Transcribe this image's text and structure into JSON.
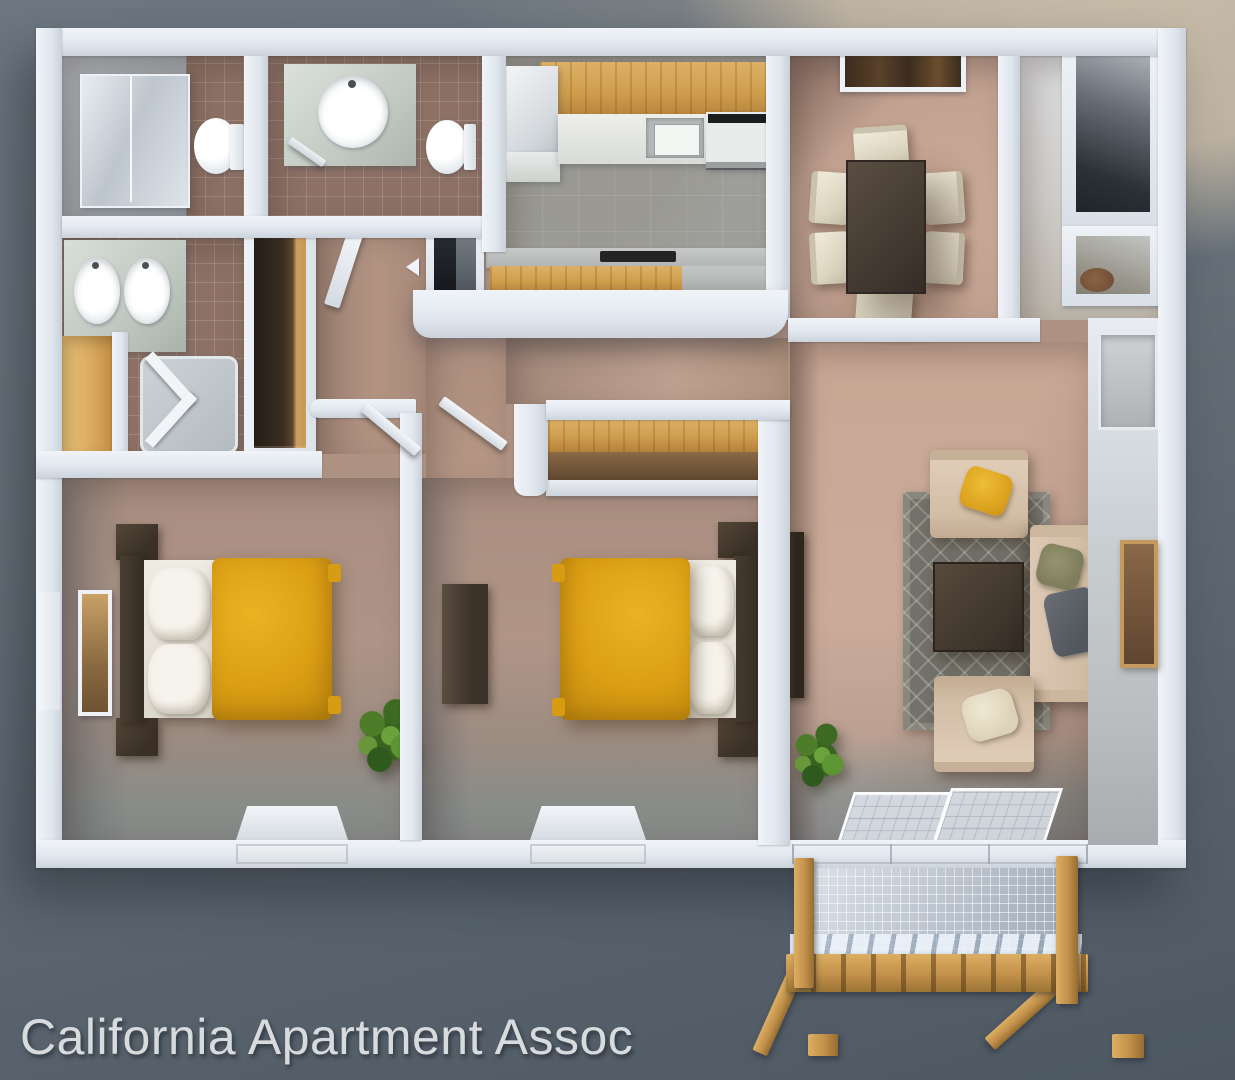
{
  "watermark": {
    "text": "California Apartment Assoc",
    "color": "#d8dbde"
  },
  "scene": {
    "type": "3d-rendered top-down apartment floor plan",
    "background_colors": {
      "slate_top": "#6d7781",
      "slate_bottom": "#4d5863",
      "beige_top_right": "#c9bca8"
    },
    "palette": {
      "wall_white": "#e8edf3",
      "bedroom_floor": "#ab9184",
      "living_floor": "#c9a897",
      "kitchen_floor": "#9e9e9a",
      "bath_tile": "#8d7165",
      "cabinet_wood": "#cf9f4e",
      "bedding_gold": "#db9e14",
      "dining_table": "#463c33",
      "chair_cream": "#e7e0ce",
      "sofa_beige": "#d6c2ac",
      "rug_gray": "#73726a",
      "balcony_wood": "#c49851"
    },
    "rooms": [
      {
        "name": "bathroom-shower",
        "furniture": [
          "glass-shower",
          "toilet",
          "tile-floor"
        ]
      },
      {
        "name": "bathroom-guest",
        "furniture": [
          "vanity-sink",
          "toilet",
          "tile-floor"
        ]
      },
      {
        "name": "master-bathroom",
        "furniture": [
          "double-sink-vanity",
          "corner-shower",
          "linen-closet"
        ]
      },
      {
        "name": "hallway",
        "furniture": [
          "wardrobe-closet",
          "pantry-closet",
          "open-door"
        ]
      },
      {
        "name": "kitchen",
        "furniture": [
          "refrigerator",
          "upper-cabinets",
          "counter-sink",
          "stove",
          "peninsula-counter",
          "half-wall"
        ]
      },
      {
        "name": "dining-area",
        "furniture": [
          "dining-table",
          "six-chairs",
          "wall-window"
        ]
      },
      {
        "name": "entry",
        "furniture": [
          "coat-closet-large",
          "coat-closet-small"
        ]
      },
      {
        "name": "bedroom-1",
        "furniture": [
          "double-bed-gold",
          "two-nightstands",
          "wall-mirror",
          "plant",
          "floor-window-light"
        ]
      },
      {
        "name": "bedroom-2",
        "furniture": [
          "double-bed-gold",
          "two-nightstands",
          "dresser",
          "closet-with-wood-shelf",
          "floor-window-light"
        ]
      },
      {
        "name": "living-room",
        "furniture": [
          "sofa",
          "armchair-top",
          "armchair-bottom",
          "coffee-table",
          "area-rug",
          "media-console",
          "wall-art",
          "plant",
          "sliding-glass-door",
          "wall-vent-window"
        ]
      },
      {
        "name": "balcony",
        "furniture": [
          "wood-posts",
          "mesh-railing",
          "wood-rail",
          "diagonal-braces"
        ]
      }
    ]
  }
}
